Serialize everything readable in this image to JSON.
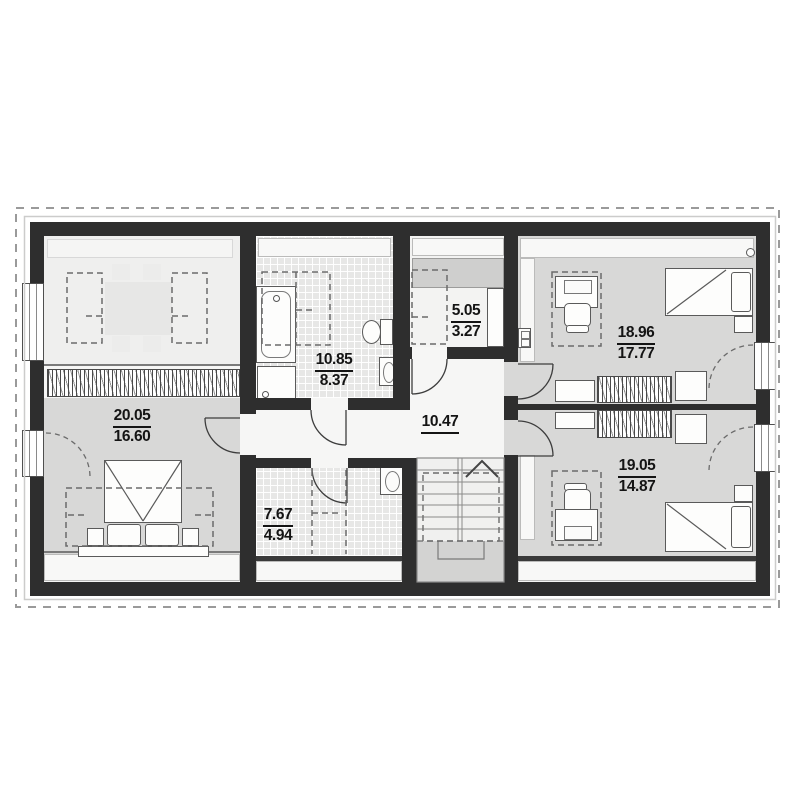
{
  "rooms": {
    "bedroom_left": {
      "total": "20.05",
      "usable": "16.60"
    },
    "bathroom_main": {
      "total": "10.85",
      "usable": "8.37"
    },
    "storage": {
      "total": "5.05",
      "usable": "3.27"
    },
    "hall": {
      "total": "10.47"
    },
    "bedroom_right_top": {
      "total": "18.96",
      "usable": "17.77"
    },
    "bedroom_right_bottom": {
      "total": "19.05",
      "usable": "14.87"
    },
    "bathroom_small": {
      "total": "7.67",
      "usable": "4.94"
    }
  },
  "colors": {
    "wall": "#2e2e2e",
    "floor_gray": "#d8d8d7",
    "floor_light": "#efefee",
    "tile_background": "#e7e7e6",
    "hall_floor": "#f6f6f5",
    "dashed_outline": "#9a9a9a",
    "label_text": "#141414"
  }
}
